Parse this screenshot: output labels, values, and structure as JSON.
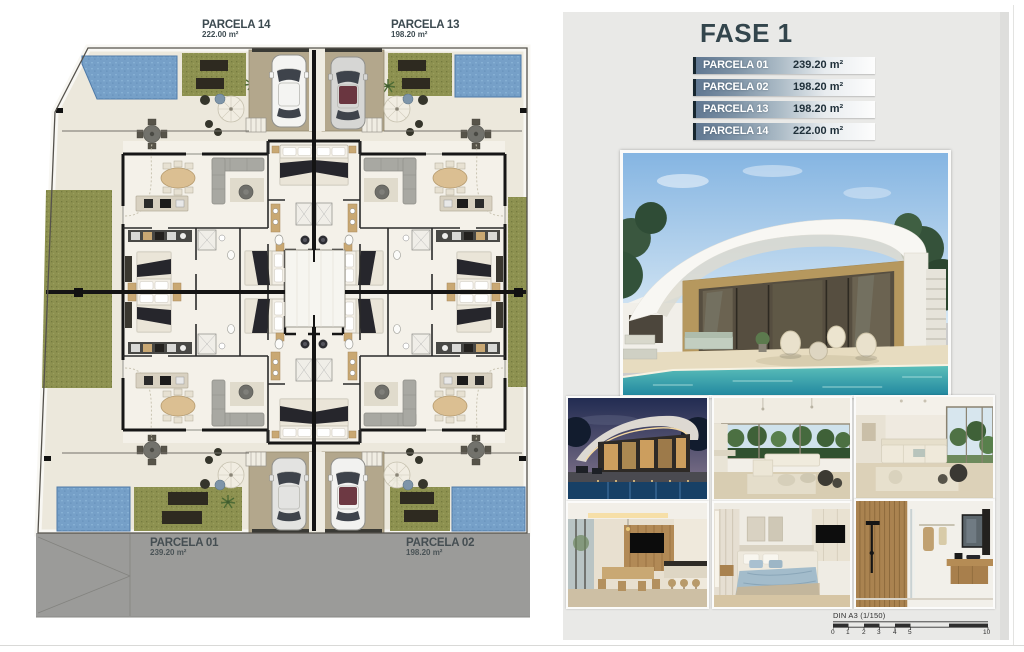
{
  "floor_plan": {
    "top_labels": [
      {
        "name": "PARCELA 14",
        "area": "222.00 m²"
      },
      {
        "name": "PARCELA 13",
        "area": "198.20 m²"
      }
    ],
    "street_labels": [
      {
        "name": "PARCELA 01",
        "area": "239.20 m²"
      },
      {
        "name": "PARCELA 02",
        "area": "198.20 m²"
      }
    ]
  },
  "side_panel": {
    "title": "FASE 1",
    "table_rows": [
      {
        "name": "PARCELA 01",
        "area": "239.20 m²"
      },
      {
        "name": "PARCELA 02",
        "area": "198.20 m²"
      },
      {
        "name": "PARCELA 13",
        "area": "198.20 m²"
      },
      {
        "name": "PARCELA 14",
        "area": "222.00 m²"
      }
    ],
    "photos": {
      "hero": "villa-exterior-pool-day",
      "thumbnails": [
        "villa-exterior-night",
        "living-room-terrace",
        "living-room",
        "kitchen-dining",
        "bedroom",
        "bathroom"
      ]
    },
    "scale_bar": {
      "label": "DIN A3 (1/150)",
      "ticks": [
        "0",
        "1",
        "2",
        "3",
        "4",
        "5",
        "10"
      ]
    }
  },
  "colors": {
    "accent_dark": "#33454c",
    "table_row_start": "#617892",
    "table_row_edge": "#17262e",
    "pool_blue": "#76a0c8",
    "grass_green": "#8d9150",
    "parking_tan": "#b3a78c",
    "road_gray": "#9b9b99",
    "terrace_cream": "#ece8dc",
    "panel_bg": "#e9e9e7",
    "wall_black": "#161616"
  }
}
